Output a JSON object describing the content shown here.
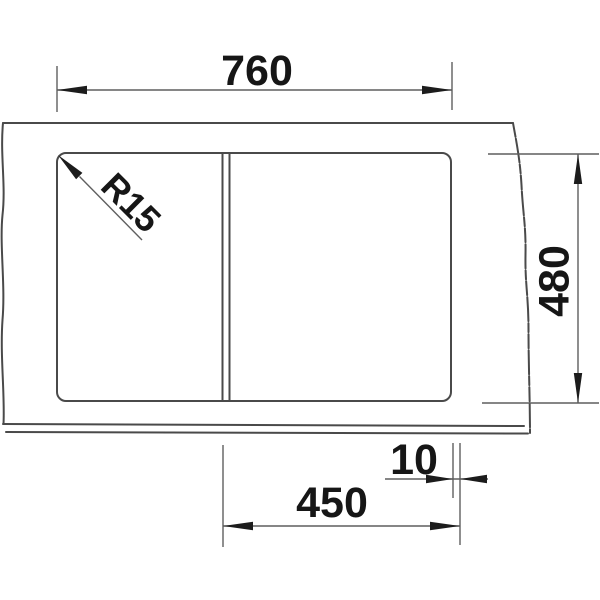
{
  "drawing": {
    "description": "sink top view dimension drawing",
    "labels": {
      "width_mm": "760",
      "depth_mm": "480",
      "bowl_width_mm": "450",
      "offset_mm": "10",
      "corner_radius": "R15"
    },
    "colors": {
      "object_line": "#4a4a4a",
      "dimension_line": "#5f5f5f",
      "text": "#161616",
      "background": "#ffffff"
    }
  }
}
